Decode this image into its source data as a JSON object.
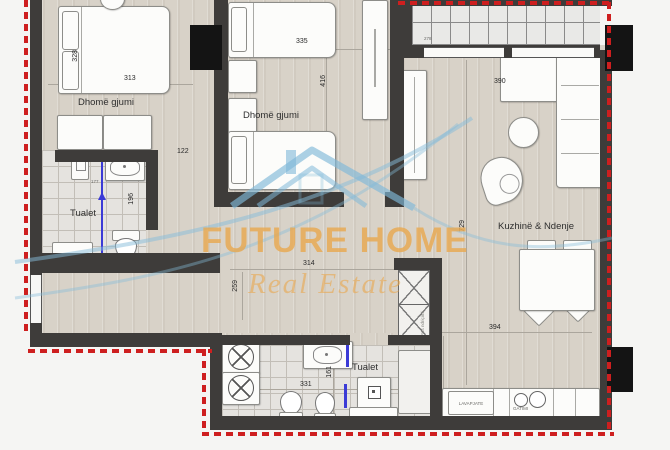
{
  "watermark": {
    "brand": "FUTURE HOME",
    "tagline": "Real Estate"
  },
  "rooms": {
    "bedroom1": {
      "name": "Dhomë gjumi",
      "width": "313",
      "depth": "328"
    },
    "bedroom2": {
      "name": "Dhomë gjumi",
      "width": "335",
      "depth": "416"
    },
    "bathroom1": {
      "name": "Tualet",
      "depth": "196",
      "width": "177"
    },
    "bathroom2": {
      "name": "Tualet",
      "width": "331",
      "depth": "161"
    },
    "living": {
      "name": "Kuzhinë & Ndenje",
      "sofa_width": "390",
      "depth": "729",
      "width": "394",
      "kitchen_depth": "296"
    },
    "balcony": {
      "width": "278"
    },
    "hall": {
      "width_upper": "122",
      "length": "314",
      "depth": "259"
    }
  },
  "kitchen": {
    "cabinet_label": "LAVAPJATE",
    "stove_label": "GATIMI"
  },
  "shaft": {
    "label": "Pus ndriçimi"
  },
  "colors": {
    "wall": "#3e3c3a",
    "floor": "#d8d2c8",
    "boundary_red": "#ce1f1f",
    "watermark_orange": "#e8a44a",
    "watermark_blue": "#85bcd9",
    "plumbing_blue": "#3b3bd6"
  }
}
